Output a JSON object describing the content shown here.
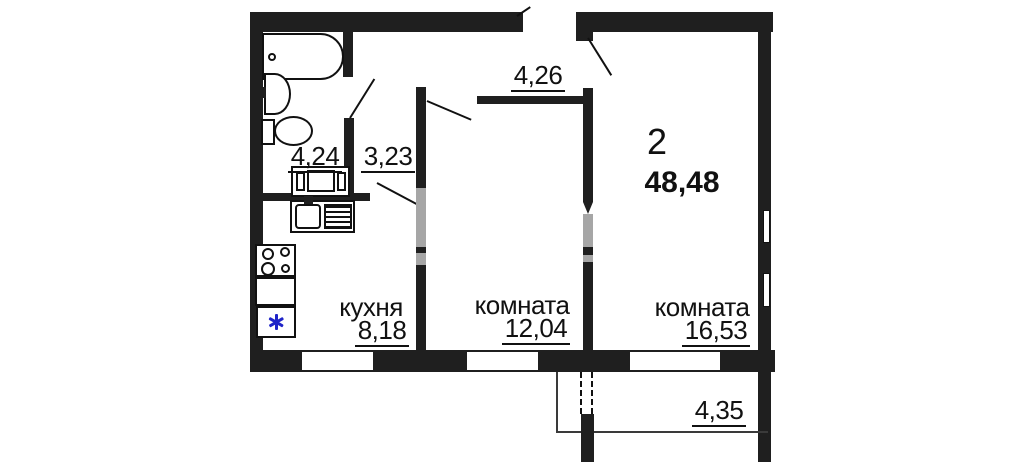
{
  "plan": {
    "type": "apartment-floor-plan",
    "summary": {
      "rooms_count": "2",
      "total_area": "48,48"
    },
    "labels": {
      "bathroom_area": "4,24",
      "corridor_area": "3,23",
      "hall_area": "4,26",
      "kitchen_name": "кухня",
      "kitchen_area": "8,18",
      "room1_name": "комната",
      "room1_area": "12,04",
      "room2_name": "комната",
      "room2_area": "16,53",
      "balcony_area": "4,35"
    },
    "colors": {
      "wall": "#1f1f1f",
      "door_opening_gray": "#a6a6a6",
      "fridge_snowflake_blue": "#1f24c8",
      "background": "#ffffff"
    },
    "icons": {
      "fridge_snowflake": "snowflake-icon",
      "bathtub": "bathtub-icon",
      "wash_basin": "wash-basin-icon",
      "toilet": "toilet-icon",
      "vanity": "vanity-cabinet-icon",
      "kitchen_sink": "kitchen-sink-icon",
      "stove": "stove-burners-icon"
    }
  }
}
